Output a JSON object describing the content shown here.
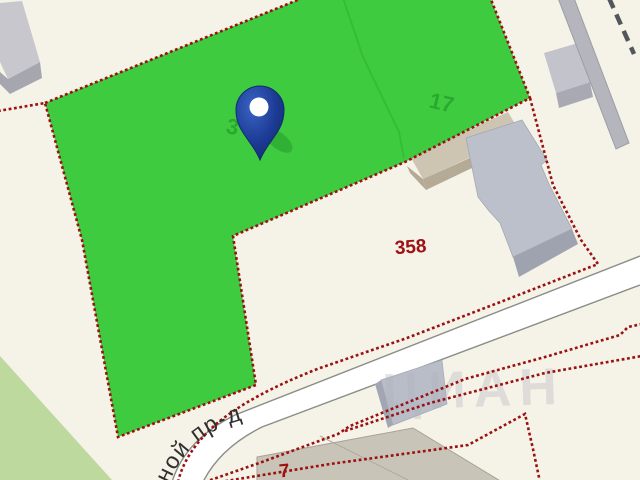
{
  "map": {
    "description": "Cadastral map fragment with highlighted land parcel and location pin",
    "labels": {
      "parcel_17": "17",
      "parcel_3": "3",
      "parcel_358": "358",
      "parcel_7": "7",
      "street": "сной пр-д",
      "watermark": "ЦИАН"
    },
    "colors": {
      "background": "#f5f2e8",
      "selected_parcel": "#3ecb40",
      "parcel_boundary": "#9b1111",
      "road_fill": "#ffffff",
      "road_edge": "#8a8d85",
      "building_gray": "#bcc0cb",
      "building_tan": "#cdc5b2",
      "vegetation": "#bdd99d",
      "pin_blue": "#1d3c96",
      "label_green": "#28a42c",
      "label_red": "#9c1212"
    }
  }
}
